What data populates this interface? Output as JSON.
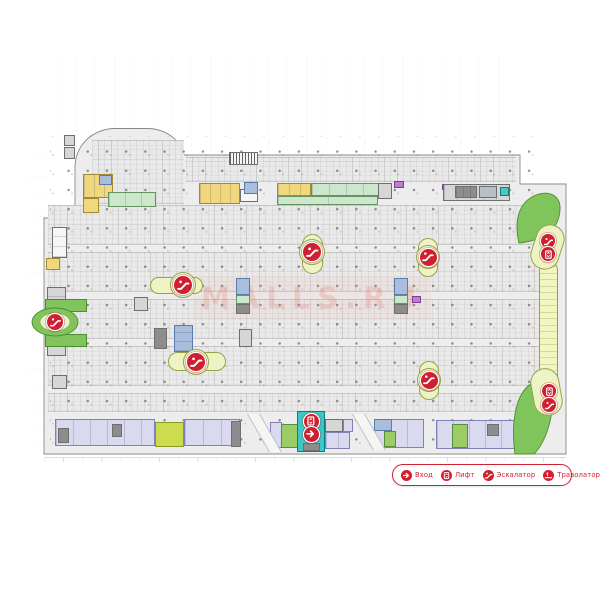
{
  "watermark": {
    "text": "MALLS.RU",
    "color": "#e0766c"
  },
  "legend": {
    "items": [
      {
        "icon": "entrance-icon",
        "label": "Вход"
      },
      {
        "icon": "lift-icon",
        "label": "Лифт"
      },
      {
        "icon": "escalator-icon",
        "label": "Эскалатор"
      },
      {
        "icon": "travolator-icon",
        "label": "Траволатор"
      }
    ],
    "accent_color": "#d01f2f"
  },
  "palette": {
    "floor": "#ededed",
    "floorEdge": "#8a8a8a",
    "yellow": "#f1d87e",
    "yellowB": "#a58a2f",
    "mint": "#cde7cd",
    "mintB": "#62955f",
    "green": "#7fc55c",
    "greenB": "#4b8d31",
    "brightGreen": "#9ccc65",
    "brightGreenB": "#55903a",
    "lavender": "#d9daf0",
    "lavenderB": "#7f82b5",
    "blue": "#a9bedd",
    "blueB": "#5a7cab",
    "teal": "#3bc6c8",
    "tealB": "#0d7e80",
    "gray": "#d6d6d6",
    "grayB": "#6f6f6f",
    "darkGray": "#8d8d8d",
    "white": "#f6f6f6",
    "purple": "#c07ad0",
    "purpleB": "#7c3f8f",
    "island": "#eef3c6",
    "islandB": "#96a449",
    "strip": "#f3f6c0",
    "red": "#d01f2f"
  },
  "map": {
    "parking_bands": [
      {
        "x": 92,
        "y": 140,
        "w": 92,
        "h": 64
      },
      {
        "x": 186,
        "y": 157,
        "w": 330,
        "h": 25
      },
      {
        "x": 48,
        "y": 205,
        "w": 492,
        "h": 40
      },
      {
        "x": 48,
        "y": 252,
        "w": 492,
        "h": 40
      },
      {
        "x": 48,
        "y": 299,
        "w": 492,
        "h": 40
      },
      {
        "x": 48,
        "y": 346,
        "w": 492,
        "h": 40
      },
      {
        "x": 48,
        "y": 393,
        "w": 492,
        "h": 19
      }
    ],
    "zones": [
      {
        "x": 64,
        "y": 135,
        "w": 11,
        "h": 11,
        "f": "gray",
        "b": "grayB"
      },
      {
        "x": 64,
        "y": 147,
        "w": 11,
        "h": 12,
        "f": "gray",
        "b": "grayB"
      },
      {
        "x": 229,
        "y": 152,
        "w": 29,
        "h": 13,
        "f": "white",
        "b": "grayB",
        "pat": "hatch"
      },
      {
        "x": 83,
        "y": 174,
        "w": 30,
        "h": 24,
        "f": "yellow",
        "b": "yellowB",
        "pat": "v10"
      },
      {
        "x": 83,
        "y": 198,
        "w": 16,
        "h": 15,
        "f": "yellow",
        "b": "yellowB"
      },
      {
        "x": 99,
        "y": 175,
        "w": 13,
        "h": 10,
        "f": "blue",
        "b": "blueB"
      },
      {
        "x": 108,
        "y": 192,
        "w": 48,
        "h": 15,
        "f": "mint",
        "b": "mintB",
        "pat": "v16"
      },
      {
        "x": 52,
        "y": 227,
        "w": 15,
        "h": 31,
        "f": "white",
        "b": "grayB",
        "pat": "h10"
      },
      {
        "x": 46,
        "y": 258,
        "w": 14,
        "h": 12,
        "f": "yellow",
        "b": "yellowB"
      },
      {
        "x": 47,
        "y": 287,
        "w": 19,
        "h": 21,
        "f": "gray",
        "b": "grayB",
        "pat": "h10"
      },
      {
        "x": 47,
        "y": 337,
        "w": 19,
        "h": 19,
        "f": "gray",
        "b": "grayB"
      },
      {
        "x": 52,
        "y": 375,
        "w": 15,
        "h": 14,
        "f": "gray",
        "b": "grayB"
      },
      {
        "x": 45,
        "y": 299,
        "w": 42,
        "h": 13,
        "f": "green",
        "b": "greenB"
      },
      {
        "x": 45,
        "y": 334,
        "w": 42,
        "h": 13,
        "f": "green",
        "b": "greenB"
      },
      {
        "x": 199,
        "y": 183,
        "w": 41,
        "h": 21,
        "f": "yellow",
        "b": "yellowB",
        "pat": "v10"
      },
      {
        "x": 240,
        "y": 189,
        "w": 18,
        "h": 13,
        "f": "white",
        "b": "grayB"
      },
      {
        "x": 244,
        "y": 182,
        "w": 14,
        "h": 12,
        "f": "blue",
        "b": "blueB"
      },
      {
        "x": 277,
        "y": 183,
        "w": 34,
        "h": 13,
        "f": "yellow",
        "b": "yellowB",
        "pat": "v11"
      },
      {
        "x": 311,
        "y": 183,
        "w": 68,
        "h": 13,
        "f": "mint",
        "b": "mintB",
        "pat": "v17"
      },
      {
        "x": 378,
        "y": 183,
        "w": 14,
        "h": 16,
        "f": "gray",
        "b": "grayB"
      },
      {
        "x": 394,
        "y": 181,
        "w": 10,
        "h": 7,
        "f": "purple",
        "b": "purpleB"
      },
      {
        "x": 277,
        "y": 196,
        "w": 101,
        "h": 9,
        "f": "mint",
        "b": "mintB",
        "pat": "v50"
      },
      {
        "x": 442,
        "y": 184,
        "w": 7,
        "h": 6,
        "f": "purple",
        "b": "purpleB"
      },
      {
        "x": 443,
        "y": 184,
        "w": 67,
        "h": 17,
        "f": "gray",
        "b": "grayB",
        "pat": "v13"
      },
      {
        "x": 455,
        "y": 186,
        "w": 22,
        "h": 12,
        "f": "darkGray",
        "b": "grayB",
        "pat": "v7"
      },
      {
        "x": 479,
        "y": 186,
        "w": 18,
        "h": 12,
        "f": "#b9bfc6",
        "b": "grayB"
      },
      {
        "x": 500,
        "y": 187,
        "w": 9,
        "h": 9,
        "f": "#52c6bd",
        "b": "tealB"
      },
      {
        "x": 236,
        "y": 278,
        "w": 14,
        "h": 17,
        "f": "blue",
        "b": "blueB"
      },
      {
        "x": 236,
        "y": 295,
        "w": 14,
        "h": 9,
        "f": "mint",
        "b": "mintB"
      },
      {
        "x": 236,
        "y": 304,
        "w": 14,
        "h": 10,
        "f": "darkGray",
        "b": "grayB"
      },
      {
        "x": 394,
        "y": 278,
        "w": 14,
        "h": 17,
        "f": "blue",
        "b": "blueB"
      },
      {
        "x": 394,
        "y": 295,
        "w": 14,
        "h": 9,
        "f": "mint",
        "b": "mintB"
      },
      {
        "x": 394,
        "y": 304,
        "w": 14,
        "h": 10,
        "f": "darkGray",
        "b": "grayB"
      },
      {
        "x": 134,
        "y": 297,
        "w": 14,
        "h": 14,
        "f": "gray",
        "b": "grayB"
      },
      {
        "x": 154,
        "y": 328,
        "w": 13,
        "h": 21,
        "f": "darkGray",
        "b": "grayB"
      },
      {
        "x": 174,
        "y": 325,
        "w": 19,
        "h": 27,
        "f": "blue",
        "b": "blueB",
        "pat": "h9"
      },
      {
        "x": 239,
        "y": 329,
        "w": 13,
        "h": 18,
        "f": "gray",
        "b": "grayB"
      },
      {
        "x": 412,
        "y": 296,
        "w": 9,
        "h": 7,
        "f": "purple",
        "b": "purpleB"
      },
      {
        "x": 55,
        "y": 419,
        "w": 100,
        "h": 27,
        "f": "lavender",
        "b": "lavenderB",
        "pat": "v17"
      },
      {
        "x": 58,
        "y": 428,
        "w": 11,
        "h": 15,
        "f": "darkGray",
        "b": "grayB"
      },
      {
        "x": 112,
        "y": 424,
        "w": 10,
        "h": 13,
        "f": "darkGray",
        "b": "grayB"
      },
      {
        "x": 155,
        "y": 422,
        "w": 29,
        "h": 25,
        "f": "#cddc4f",
        "b": "#8a9a20"
      },
      {
        "x": 184,
        "y": 419,
        "w": 56,
        "h": 27,
        "f": "lavender",
        "b": "lavenderB",
        "pat": "v18"
      },
      {
        "x": 231,
        "y": 421,
        "w": 10,
        "h": 26,
        "f": "darkGray",
        "b": "grayB"
      },
      {
        "x": 270,
        "y": 422,
        "w": 12,
        "h": 26,
        "f": "lavender",
        "b": "lavenderB"
      },
      {
        "x": 281,
        "y": 424,
        "w": 17,
        "h": 24,
        "f": "brightGreen",
        "b": "brightGreenB"
      },
      {
        "x": 325,
        "y": 419,
        "w": 18,
        "h": 13,
        "f": "gray",
        "b": "grayB"
      },
      {
        "x": 325,
        "y": 432,
        "w": 25,
        "h": 17,
        "f": "lavender",
        "b": "lavenderB",
        "pat": "v12"
      },
      {
        "x": 343,
        "y": 419,
        "w": 10,
        "h": 13,
        "f": "lavender",
        "b": "lavenderB"
      },
      {
        "x": 297,
        "y": 411,
        "w": 28,
        "h": 41,
        "f": "teal",
        "b": "tealB"
      },
      {
        "x": 303,
        "y": 443,
        "w": 17,
        "h": 8,
        "f": "darkGray",
        "b": "grayB"
      },
      {
        "x": 374,
        "y": 419,
        "w": 50,
        "h": 29,
        "f": "lavender",
        "b": "lavenderB",
        "pat": "v16"
      },
      {
        "x": 374,
        "y": 419,
        "w": 18,
        "h": 12,
        "f": "blue",
        "b": "blueB"
      },
      {
        "x": 384,
        "y": 431,
        "w": 12,
        "h": 16,
        "f": "brightGreen",
        "b": "brightGreenB"
      },
      {
        "x": 436,
        "y": 420,
        "w": 95,
        "h": 29,
        "f": "lavender",
        "b": "lavenderB",
        "pat": "v16"
      },
      {
        "x": 452,
        "y": 424,
        "w": 16,
        "h": 24,
        "f": "brightGreen",
        "b": "brightGreenB"
      },
      {
        "x": 487,
        "y": 424,
        "w": 12,
        "h": 12,
        "f": "darkGray",
        "b": "grayB"
      },
      {
        "x": 539,
        "y": 261,
        "w": 19,
        "h": 124,
        "f": "strip",
        "b": "islandB",
        "pat": "rungs",
        "r": 9
      }
    ],
    "islands": [
      {
        "x": 150,
        "y": 277,
        "w": 53,
        "h": 17,
        "c": [
          183,
          285,
          13
        ]
      },
      {
        "x": 168,
        "y": 352,
        "w": 58,
        "h": 19,
        "c": [
          196,
          362,
          13
        ]
      },
      {
        "x": 302,
        "y": 234,
        "w": 21,
        "h": 40,
        "c": [
          312,
          252,
          13
        ]
      },
      {
        "x": 418,
        "y": 238,
        "w": 20,
        "h": 39,
        "c": [
          428,
          257,
          12
        ]
      },
      {
        "x": 419,
        "y": 361,
        "w": 20,
        "h": 39,
        "c": [
          429,
          380,
          12
        ]
      },
      {
        "x": 533,
        "y": 224,
        "w": 29,
        "h": 46,
        "rot": 18
      },
      {
        "x": 532,
        "y": 368,
        "w": 29,
        "h": 48,
        "rot": -10
      }
    ],
    "icons": [
      {
        "t": "escalator",
        "x": 55,
        "y": 322,
        "s": 16
      },
      {
        "t": "escalator",
        "x": 183,
        "y": 285,
        "s": 18
      },
      {
        "t": "escalator",
        "x": 196,
        "y": 362,
        "s": 18
      },
      {
        "t": "escalator",
        "x": 312,
        "y": 252,
        "s": 18
      },
      {
        "t": "escalator",
        "x": 428,
        "y": 257,
        "s": 17
      },
      {
        "t": "escalator",
        "x": 429,
        "y": 380,
        "s": 17
      },
      {
        "t": "escalator",
        "x": 548,
        "y": 241,
        "s": 14
      },
      {
        "t": "lift",
        "x": 548,
        "y": 254,
        "s": 14
      },
      {
        "t": "lift",
        "x": 311,
        "y": 421,
        "s": 15
      },
      {
        "t": "entrance",
        "x": 311,
        "y": 434,
        "s": 15
      },
      {
        "t": "lift",
        "x": 549,
        "y": 391,
        "s": 14
      },
      {
        "t": "escalator",
        "x": 549,
        "y": 405,
        "s": 14
      }
    ]
  }
}
